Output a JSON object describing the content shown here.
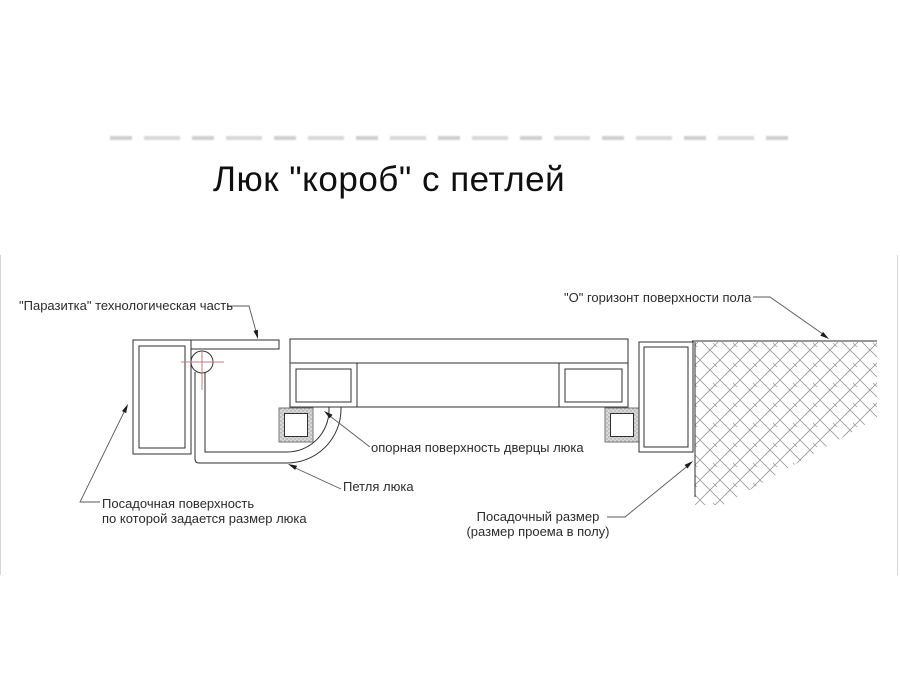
{
  "title": "Люк \"короб\" с петлей",
  "labels": {
    "parazitka": "\"Паразитка\" технологическая часть",
    "floor_horizon": "\"О\" горизонт поверхности пола",
    "door_support": "опорная поверхность дверцы люка",
    "hinge": "Петля люка",
    "seating_surface_line1": "Посадочная поверхность",
    "seating_surface_line2": "по которой задается размер люка",
    "seating_size_line1": "Посадочный размер",
    "seating_size_line2": "(размер проема в полу)"
  },
  "colors": {
    "line": "#2f2f2f",
    "hatch": "#9b9b9b",
    "leader": "#5a5a5a",
    "crosshair": "#c17f7f",
    "edge": "#d7d7d7"
  }
}
